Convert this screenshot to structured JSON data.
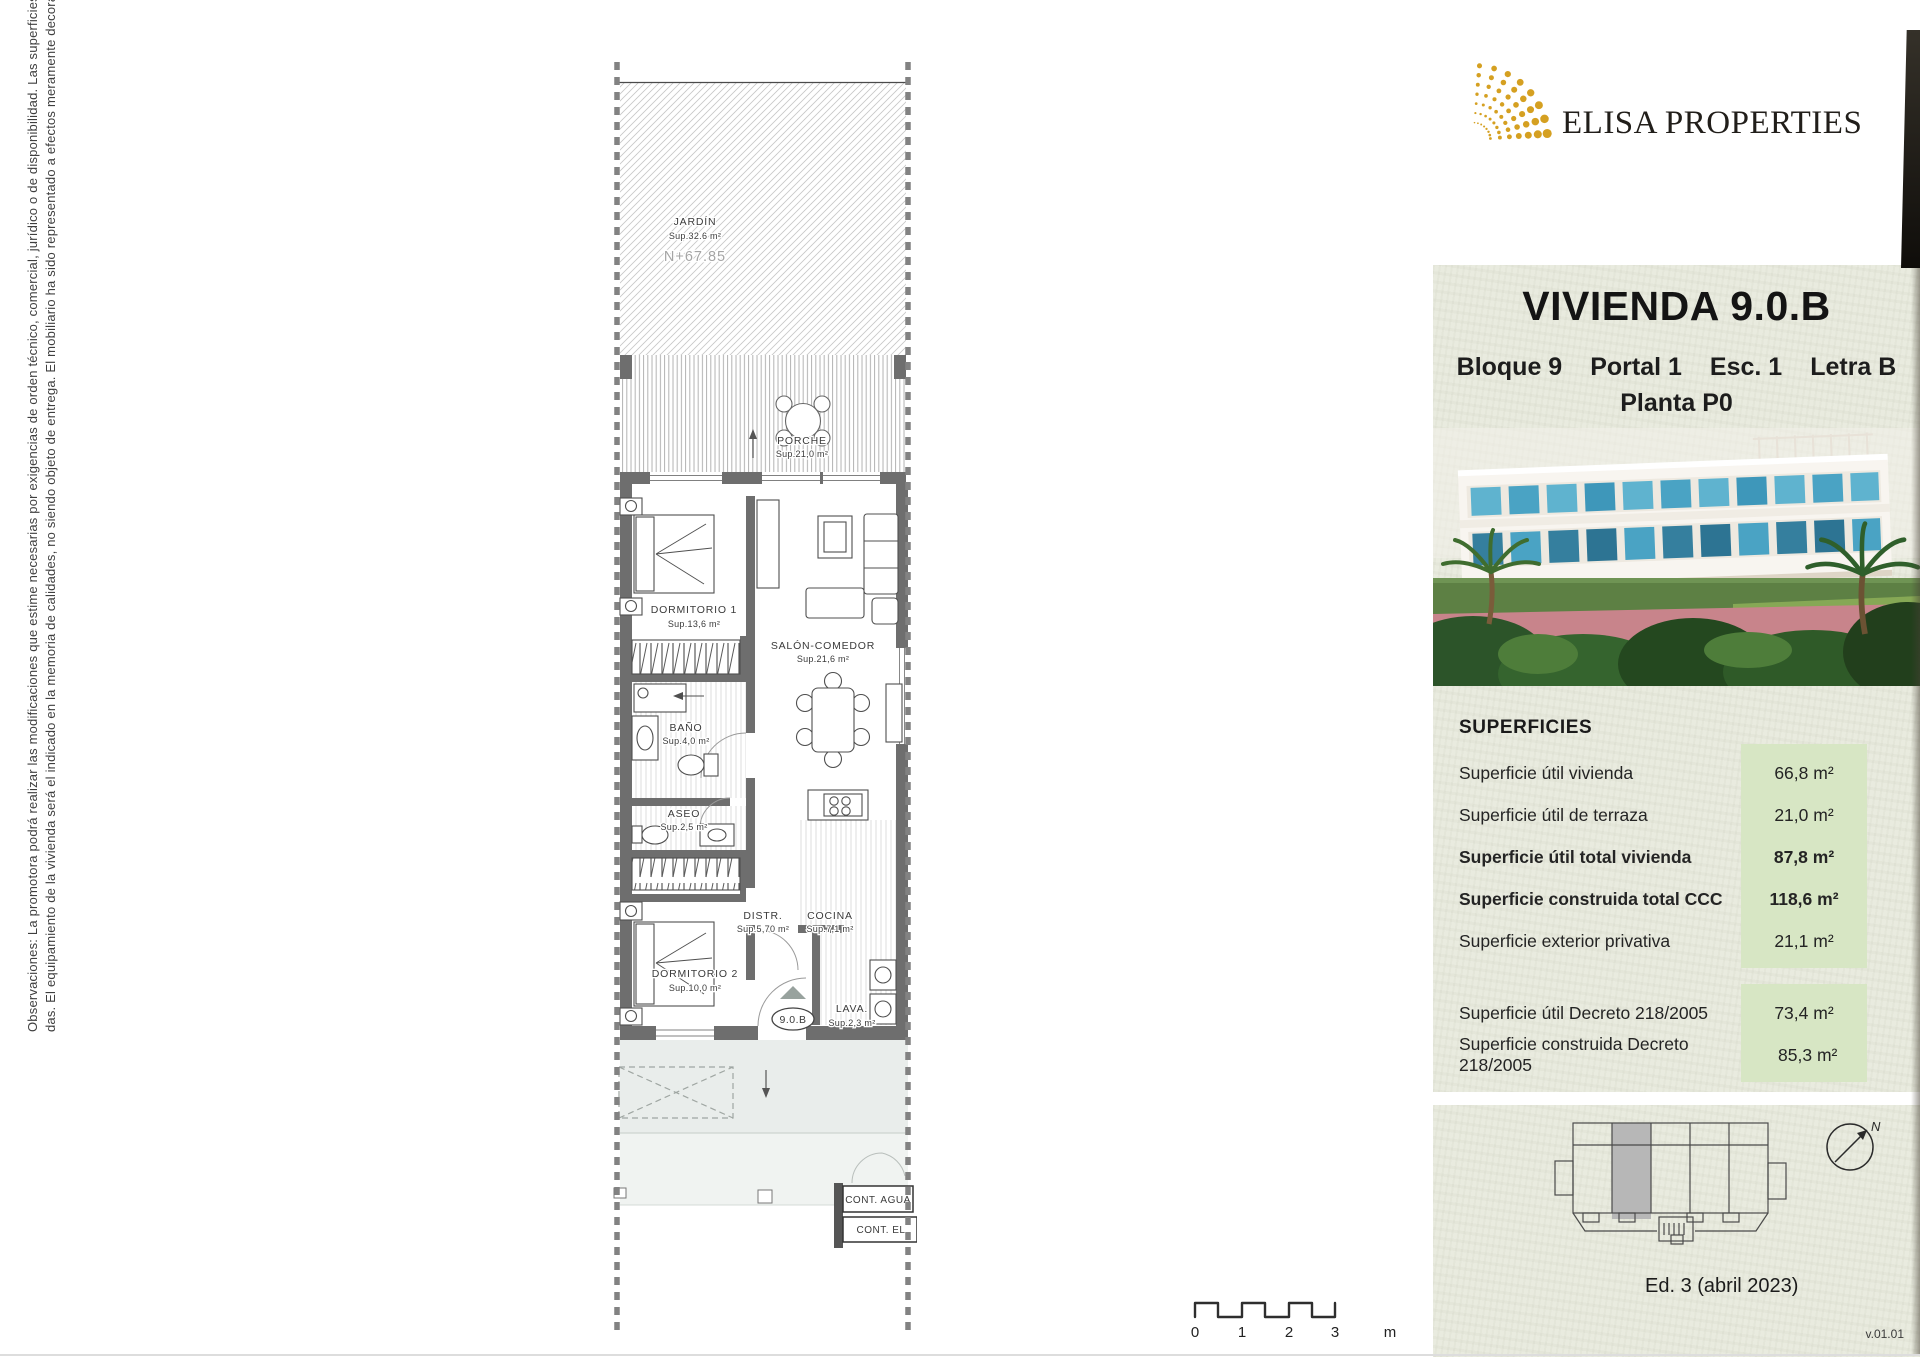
{
  "disclaimer": {
    "line1": "Observaciones: La promotora podrá realizar las modificaciones que estime necesarias por exigencias de orden técnico, comercial, jurídico o de disponibilidad. Las superficies detalladas son aproxima-",
    "line2": "das. El equipamiento de la vivienda será el indicado en la memoria de calidades, no siendo objeto de entrega. El mobiliario ha sido representado a efectos meramente decorativos. Versión 01."
  },
  "brand": {
    "name": "ELISA PROPERTIES",
    "logo_color": "#D5A021"
  },
  "unit_card": {
    "title": "VIVIENDA 9.0.B",
    "subtitle_parts": [
      "Bloque 9",
      "Portal 1",
      "Esc. 1",
      "Letra B"
    ],
    "planta": "Planta P0"
  },
  "superficies": {
    "heading": "SUPERFICIES",
    "highlight_color": "#d7e6c4",
    "rows": [
      {
        "label": "Superficie útil vivienda",
        "value": "66,8 m²"
      },
      {
        "label": "Superficie útil de terraza",
        "value": "21,0 m²"
      },
      {
        "label": "Superficie útil total vivienda",
        "value": "87,8 m²"
      },
      {
        "label": "Superficie construida total CCC",
        "value": "118,6 m²"
      },
      {
        "label": "Superficie exterior privativa",
        "value": "21,1 m²"
      },
      {
        "label": "Superficie útil Decreto 218/2005",
        "value": "73,4 m²"
      },
      {
        "label": "Superficie construida Decreto 218/2005",
        "value": "85,3 m²"
      }
    ]
  },
  "keyplan": {
    "edition": "Ed. 3 (abril 2023)",
    "version": "v.01.01",
    "north_label": "N"
  },
  "scalebar": {
    "ticks": [
      "0",
      "1",
      "2",
      "3"
    ],
    "unit": "m"
  },
  "floorplan": {
    "unit_badge": "9.0.B",
    "rooms": [
      {
        "name": "JARDÍN",
        "area": "Sup.32.6 m²",
        "level": "N+67.85"
      },
      {
        "name": "PORCHE",
        "area": "Sup.21,0 m²"
      },
      {
        "name": "DORMITORIO 1",
        "area": "Sup.13,6 m²"
      },
      {
        "name": "SALÓN-COMEDOR",
        "area": "Sup.21,6 m²"
      },
      {
        "name": "BAÑO",
        "area": "Sup.4,0 m²"
      },
      {
        "name": "ASEO",
        "area": "Sup.2,5 m²"
      },
      {
        "name": "DISTR.",
        "area": "Sup.5,70 m²"
      },
      {
        "name": "COCINA",
        "area": "Sup.7,1 m²"
      },
      {
        "name": "DORMITORIO 2",
        "area": "Sup.10,0 m²"
      },
      {
        "name": "LAVA.",
        "area": "Sup.2,3 m²"
      }
    ],
    "labels": {
      "cont_agua": "CONT. AGUA",
      "cont_el": "CONT. EL"
    }
  }
}
